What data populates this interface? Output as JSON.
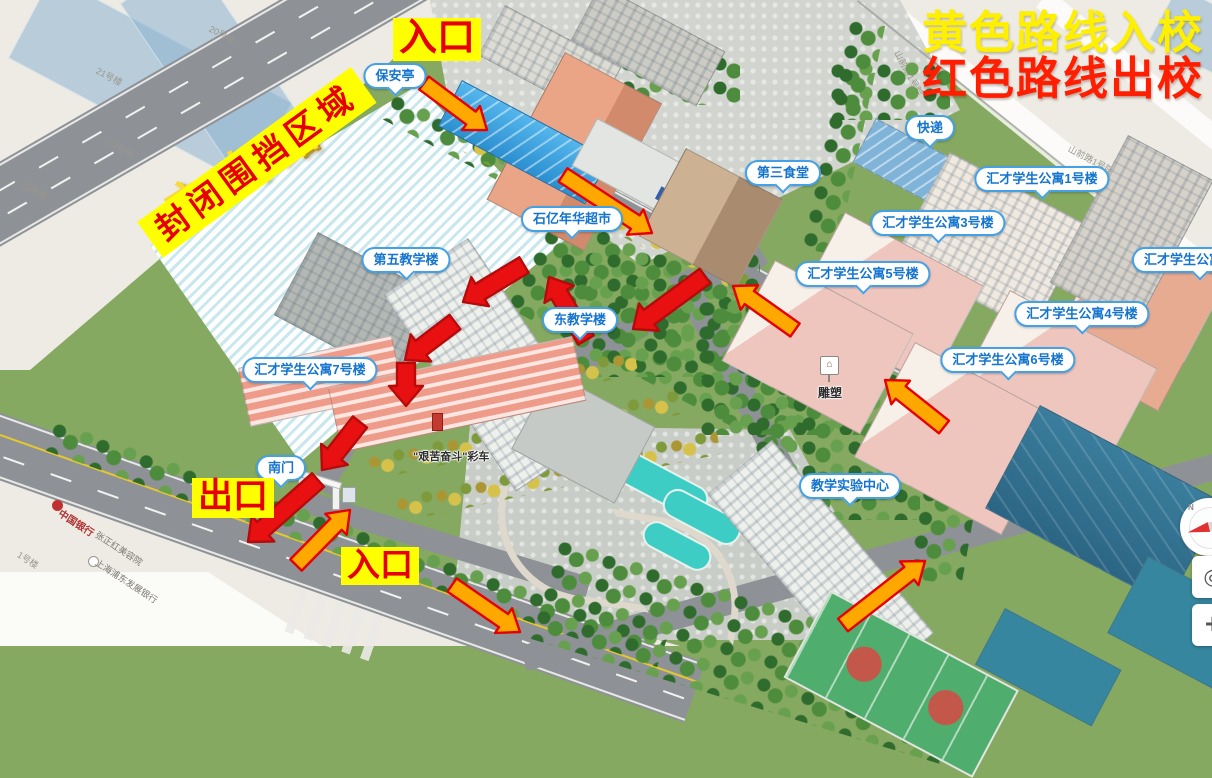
{
  "legend": {
    "line1": "黄色路线入校",
    "line2": "红色路线出校"
  },
  "routes": {
    "enter_color": "#ffa800",
    "exit_color": "#e81010"
  },
  "overlays": {
    "entrance_top": "入口",
    "entrance_bottom": "入口",
    "exit": "出口",
    "closed_area": "封闭围挡区域"
  },
  "bubbles": {
    "security": "保安亭",
    "supermarket": "石亿年华超市",
    "canteen3": "第三食堂",
    "express": "快递",
    "apt1": "汇才学生公寓1号楼",
    "apt2": "汇才学生公寓2号楼",
    "apt3": "汇才学生公寓3号楼",
    "apt4": "汇才学生公寓4号楼",
    "apt5": "汇才学生公寓5号楼",
    "apt6": "汇才学生公寓6号楼",
    "apt7": "汇才学生公寓7号楼",
    "teach5": "第五教学楼",
    "teach_east": "东教学楼",
    "south_gate": "南门",
    "experiment_center": "教学实验中心"
  },
  "ground_labels": {
    "sculpture": "雕塑",
    "sculpture_icon": "⌂",
    "float": "\"艰苦奋斗\"彩车",
    "road_fangshan": "方山路"
  },
  "basemap": {
    "bldg20": "20号楼",
    "bldg21": "21号楼",
    "bldg22": "22号楼",
    "bldg23": "23号楼",
    "court_a": "山前路1号院",
    "court_b": "山前路1号院",
    "bank": "中国银行",
    "beauty": "张正红美容院",
    "spdb": "上海浦东发展银行",
    "bldg1": "1号楼"
  },
  "controls": {
    "compass_n": "N",
    "locate_icon": "◎",
    "zoom_in": "+"
  }
}
